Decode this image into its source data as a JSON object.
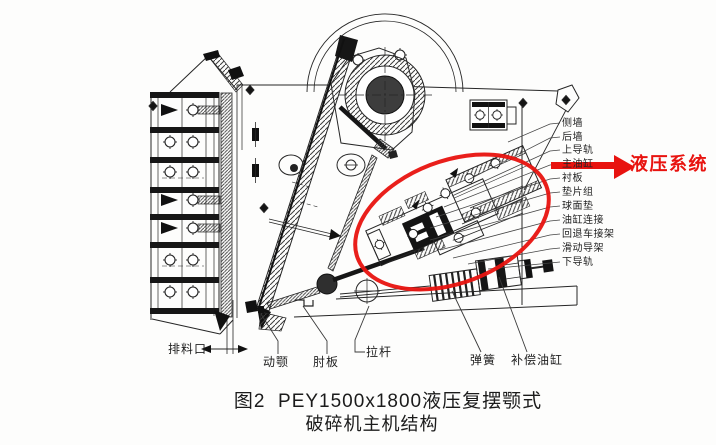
{
  "figure": {
    "caption_line1": "图2  PEY1500x1800液压复摆颚式",
    "caption_line2": "破碎机主机结构"
  },
  "annotation": {
    "hydraulic_system": "液压系统",
    "highlight_color": "#e8130f"
  },
  "part_labels": {
    "right": [
      "侧墙",
      "后墙",
      "上导轨",
      "主油缸",
      "衬板",
      "垫片组",
      "球面垫",
      "油缸连接",
      "回退车接架",
      "滑动导架",
      "下导轨"
    ],
    "bottom": [
      "排料口",
      "动颚",
      "肘板",
      "拉杆",
      "弹簧",
      "补偿油缸"
    ]
  }
}
